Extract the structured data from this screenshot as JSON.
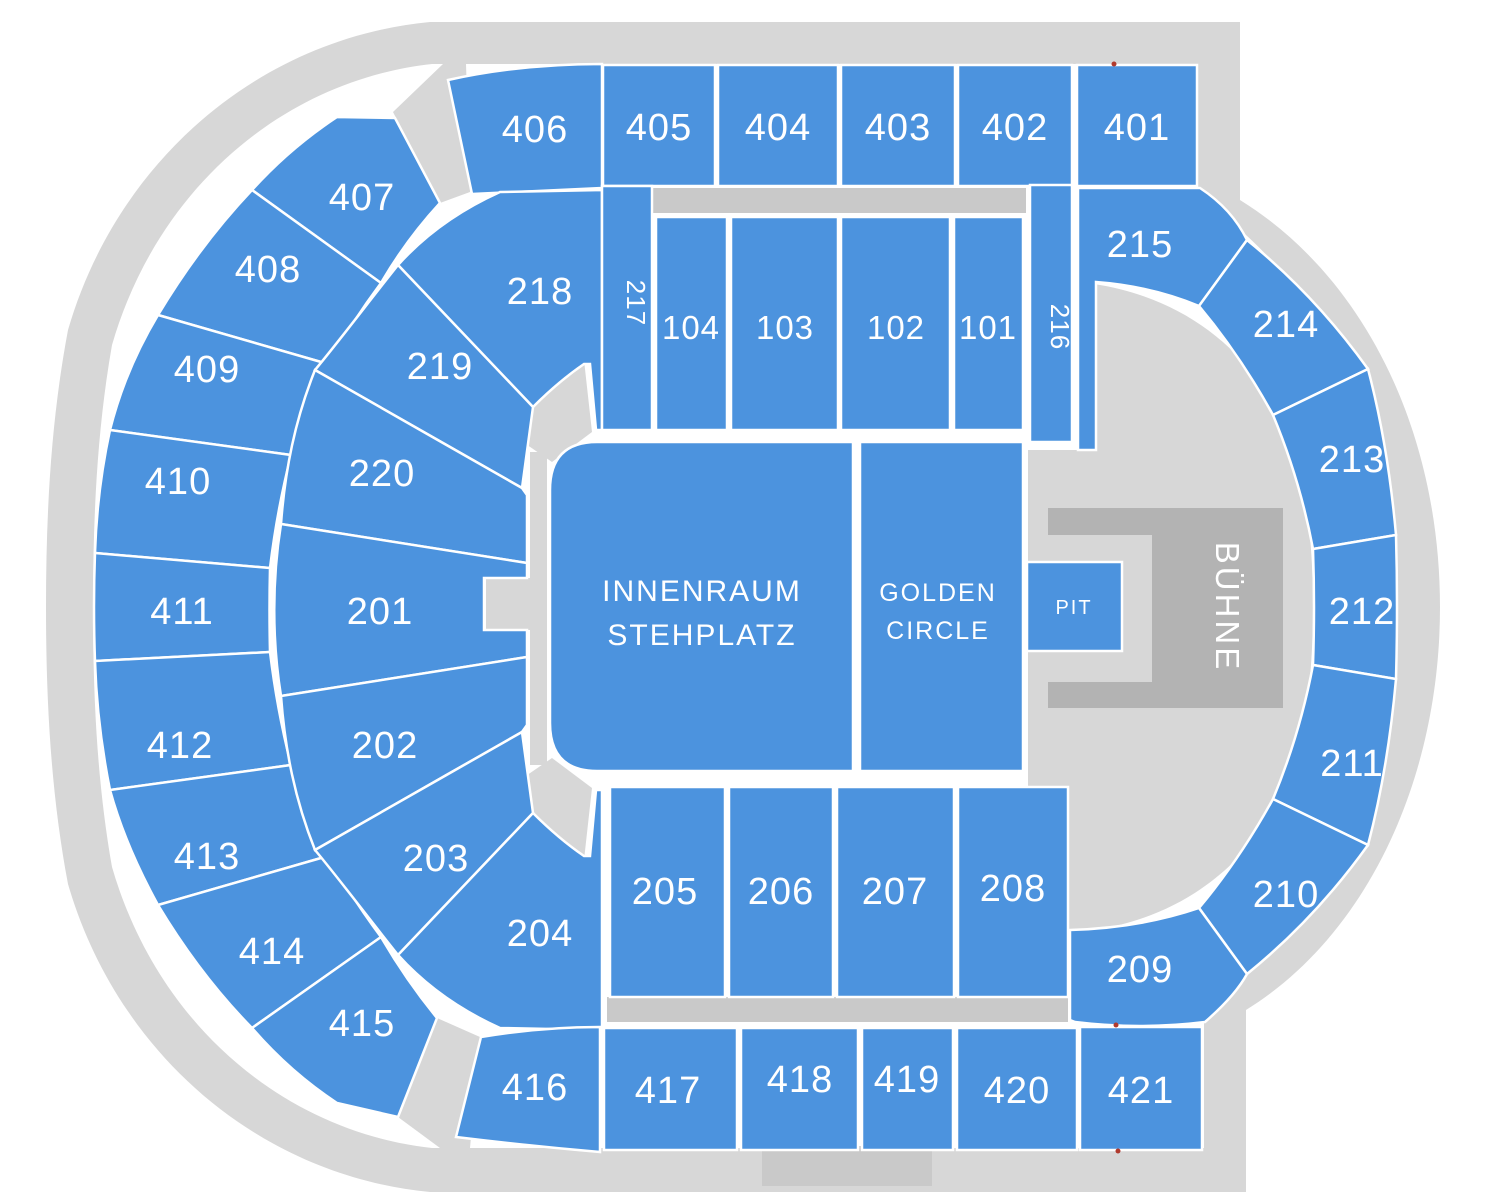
{
  "title": "Arena seating map",
  "colors": {
    "section_blue": "#4C93DE",
    "concourse_gray": "#D7D7D7",
    "entry_band_gray": "#C9C9C9",
    "stage_gray": "#B3B3B3",
    "label_white": "#FFFFFF",
    "marker_red": "#B03A2E"
  },
  "sections": {
    "s401": "401",
    "s402": "402",
    "s403": "403",
    "s404": "404",
    "s405": "405",
    "s406": "406",
    "s407": "407",
    "s408": "408",
    "s409": "409",
    "s410": "410",
    "s411": "411",
    "s412": "412",
    "s413": "413",
    "s414": "414",
    "s415": "415",
    "s416": "416",
    "s417": "417",
    "s418": "418",
    "s419": "419",
    "s420": "420",
    "s421": "421",
    "s201": "201",
    "s202": "202",
    "s203": "203",
    "s204": "204",
    "s205": "205",
    "s206": "206",
    "s207": "207",
    "s208": "208",
    "s209": "209",
    "s210": "210",
    "s211": "211",
    "s212": "212",
    "s213": "213",
    "s214": "214",
    "s215": "215",
    "s216": "216",
    "s217": "217",
    "s218": "218",
    "s219": "219",
    "s220": "220",
    "s101": "101",
    "s102": "102",
    "s103": "103",
    "s104": "104"
  },
  "floor": {
    "innenraum_1": "INNENRAUM",
    "innenraum_2": "STEHPLATZ",
    "golden_1": "GOLDEN",
    "golden_2": "CIRCLE",
    "pit": "PIT",
    "stage": "BÜHNE"
  }
}
